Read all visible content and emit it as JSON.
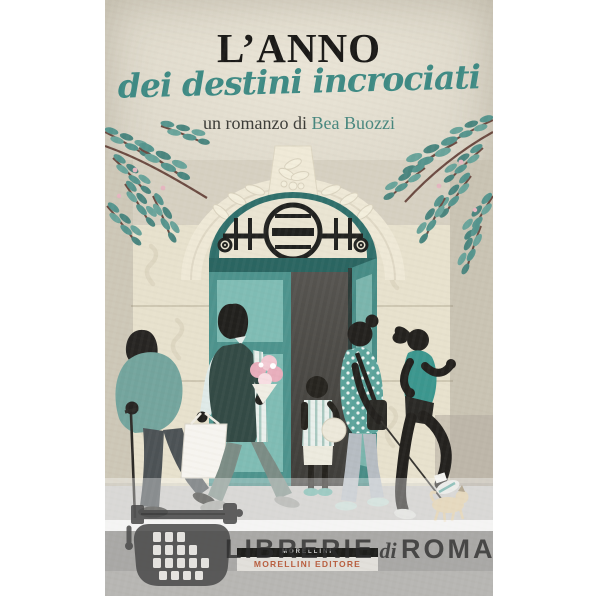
{
  "cover": {
    "title": "L’ANNO",
    "subtitle": "dei destini incrociati",
    "byline_prefix": "un romanzo di ",
    "author": "Bea Buozzi"
  },
  "publisher": {
    "name": "MORELLINI",
    "tagline": "MORELLINI EDITORE"
  },
  "watermark": {
    "word1": "LIBRERIE",
    "word2": "di",
    "word3": "ROMA",
    "icon": "typewriter-icon"
  },
  "colors": {
    "background_beige": "#d7d2c4",
    "stone_cream": "#e9e3d0",
    "door_teal_dark": "#2f6f6b",
    "door_teal": "#4d938d",
    "glass_teal": "#7fbcb4",
    "leaf_teal": "#55948d",
    "title_black": "#1a1917",
    "script_teal": "#3e8a84",
    "publisher_orange": "#c8603c",
    "watermark_gray": "#3c3c3c",
    "pavement_gray": "#c5c4c1"
  },
  "illustration_figures": [
    "elderly-man-with-cane",
    "man-with-flowers-and-tote-bag",
    "child-with-ball",
    "woman-with-shoulder-bag",
    "jogging-woman",
    "small-dog"
  ]
}
